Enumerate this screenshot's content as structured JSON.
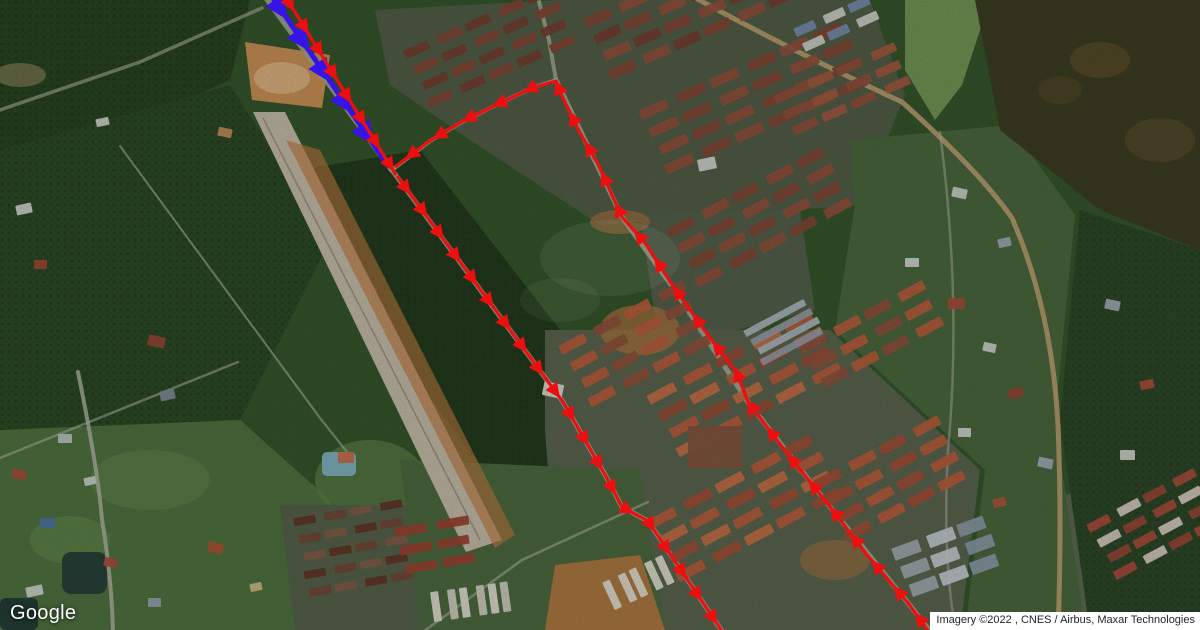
{
  "map": {
    "logo_text": "Google",
    "attribution": "Imagery ©2022 , CNES / Airbus, Maxar Technologies"
  },
  "routes": {
    "blue": {
      "color": "#3613e6",
      "line_width": 5,
      "arrow_length": 24,
      "arrow_half_width": 11,
      "spacing": 38,
      "phase": 24,
      "points": [
        [
          266,
          -12
        ],
        [
          389,
          167
        ]
      ]
    },
    "red": {
      "color": "#ed0f0f",
      "line_width": 3.2,
      "arrow_length": 15,
      "arrow_half_width": 7.2,
      "segments": [
        {
          "spacing": 27,
          "phase": 18,
          "points": [
            [
              280,
              -12
            ],
            [
              396,
              175
            ]
          ]
        },
        {
          "spacing": 28,
          "phase": 14,
          "points": [
            [
              397,
              176
            ],
            [
              563,
              402
            ],
            [
              608,
              480
            ],
            [
              622,
              507
            ],
            [
              648,
              521
            ],
            [
              724,
              634
            ]
          ]
        },
        {
          "spacing": 34,
          "phase": 20,
          "points": [
            [
              932,
              636
            ],
            [
              908,
              603
            ],
            [
              868,
              556
            ],
            [
              827,
              503
            ],
            [
              786,
              452
            ],
            [
              748,
              402
            ],
            [
              737,
              373
            ],
            [
              710,
              338
            ],
            [
              673,
              286
            ],
            [
              645,
              243
            ],
            [
              622,
              217
            ],
            [
              598,
              164
            ],
            [
              580,
              133
            ],
            [
              562,
              96
            ],
            [
              556,
              81
            ],
            [
              532,
              88
            ],
            [
              500,
              103
            ],
            [
              463,
              121
            ],
            [
              428,
              142
            ],
            [
              395,
              167
            ]
          ]
        }
      ]
    }
  },
  "map_features": {
    "building_clusters": [
      {
        "x": 585,
        "y": 18,
        "angle": -24,
        "rows": 4,
        "cols": 8,
        "w": 28,
        "h": 10,
        "gx": 7,
        "gy": 9,
        "colors": [
          "#7b4433",
          "#8a4e3a",
          "#6f3d2e"
        ]
      },
      {
        "x": 640,
        "y": 110,
        "angle": -24,
        "rows": 4,
        "cols": 6,
        "w": 30,
        "h": 10,
        "gx": 8,
        "gy": 10,
        "colors": [
          "#8a4e3a",
          "#7b4433"
        ]
      },
      {
        "x": 405,
        "y": 50,
        "angle": -24,
        "rows": 4,
        "cols": 5,
        "w": 26,
        "h": 9,
        "gx": 7,
        "gy": 9,
        "colors": [
          "#6f3d2e",
          "#7b4433"
        ]
      },
      {
        "x": 775,
        "y": 95,
        "angle": -24,
        "rows": 3,
        "cols": 4,
        "w": 26,
        "h": 9,
        "gx": 8,
        "gy": 9,
        "colors": [
          "#8a4e3a",
          "#9a563e"
        ]
      },
      {
        "x": 795,
        "y": 28,
        "angle": -24,
        "rows": 2,
        "cols": 3,
        "w": 22,
        "h": 9,
        "gx": 7,
        "gy": 8,
        "colors": [
          "#7288a8",
          "#c4c9c2"
        ]
      },
      {
        "x": 668,
        "y": 228,
        "angle": -28,
        "rows": 4,
        "cols": 5,
        "w": 28,
        "h": 10,
        "gx": 8,
        "gy": 9,
        "colors": [
          "#7b4433",
          "#8a4e3a"
        ]
      },
      {
        "x": 560,
        "y": 345,
        "angle": -28,
        "rows": 4,
        "cols": 4,
        "w": 28,
        "h": 10,
        "gx": 8,
        "gy": 10,
        "colors": [
          "#b05a3a",
          "#8a4e3a"
        ]
      },
      {
        "x": 648,
        "y": 395,
        "angle": -28,
        "rows": 4,
        "cols": 5,
        "w": 30,
        "h": 10,
        "gx": 8,
        "gy": 10,
        "colors": [
          "#bc6a42",
          "#b05a3a",
          "#8f4a34"
        ]
      },
      {
        "x": 800,
        "y": 345,
        "angle": -28,
        "rows": 3,
        "cols": 4,
        "w": 28,
        "h": 10,
        "gx": 8,
        "gy": 10,
        "colors": [
          "#8a4e3a",
          "#b05a3a"
        ]
      },
      {
        "x": 745,
        "y": 330,
        "angle": -28,
        "rows": 4,
        "cols": 1,
        "w": 68,
        "h": 7,
        "gx": 0,
        "gy": 4,
        "colors": [
          "#a7aeb4",
          "#8e969e"
        ]
      },
      {
        "x": 648,
        "y": 520,
        "angle": -28,
        "rows": 4,
        "cols": 5,
        "w": 30,
        "h": 10,
        "gx": 8,
        "gy": 10,
        "colors": [
          "#b05a3a",
          "#9a4c36",
          "#bc6a42"
        ]
      },
      {
        "x": 815,
        "y": 480,
        "angle": -28,
        "rows": 4,
        "cols": 4,
        "w": 28,
        "h": 10,
        "gx": 8,
        "gy": 10,
        "colors": [
          "#9a4c36",
          "#b05a3a"
        ]
      },
      {
        "x": 1088,
        "y": 524,
        "angle": -28,
        "rows": 4,
        "cols": 4,
        "w": 24,
        "h": 9,
        "gx": 7,
        "gy": 9,
        "colors": [
          "#a04a3a",
          "#cdc4b8",
          "#8f4434"
        ]
      },
      {
        "x": 893,
        "y": 548,
        "angle": -20,
        "rows": 3,
        "cols": 3,
        "w": 28,
        "h": 13,
        "gx": 6,
        "gy": 7,
        "colors": [
          "#9aa3a8",
          "#bcc4c8",
          "#8794a0"
        ]
      },
      {
        "x": 295,
        "y": 518,
        "angle": -10,
        "rows": 5,
        "cols": 4,
        "w": 22,
        "h": 8,
        "gx": 6,
        "gy": 10,
        "colors": [
          "#5e3427",
          "#6d4433",
          "#7a5a44"
        ]
      },
      {
        "x": 396,
        "y": 528,
        "angle": -10,
        "rows": 3,
        "cols": 2,
        "w": 32,
        "h": 9,
        "gx": 8,
        "gy": 10,
        "colors": [
          "#93402e"
        ]
      },
      {
        "x": 432,
        "y": 592,
        "angle": -8,
        "rows": 1,
        "cols": 6,
        "w": 8,
        "h": 30,
        "gx": 6,
        "gy": 0,
        "colors": [
          "#d8d5c8",
          "#c9c6ba"
        ]
      },
      {
        "x": 604,
        "y": 582,
        "angle": -25,
        "rows": 1,
        "cols": 5,
        "w": 8,
        "h": 30,
        "gx": 6,
        "gy": 0,
        "colors": [
          "#d8d5c8"
        ]
      }
    ],
    "houses": [
      [
        16,
        204,
        16,
        10,
        "#c6cbc4"
      ],
      [
        34,
        260,
        13,
        9,
        "#9c4434"
      ],
      [
        148,
        336,
        17,
        11,
        "#8f4434"
      ],
      [
        160,
        390,
        15,
        10,
        "#7a8890"
      ],
      [
        58,
        434,
        14,
        9,
        "#b6bdb9"
      ],
      [
        12,
        470,
        14,
        9,
        "#a34a38"
      ],
      [
        84,
        477,
        12,
        8,
        "#c2c8c4"
      ],
      [
        40,
        518,
        15,
        10,
        "#4d6f9e"
      ],
      [
        104,
        558,
        13,
        9,
        "#a34a38"
      ],
      [
        26,
        586,
        17,
        10,
        "#c6cbc4"
      ],
      [
        148,
        598,
        13,
        9,
        "#8f9ba5"
      ],
      [
        208,
        543,
        15,
        10,
        "#a8502e"
      ],
      [
        250,
        583,
        12,
        8,
        "#c4b47c"
      ],
      [
        338,
        452,
        16,
        11,
        "#c06848"
      ],
      [
        952,
        188,
        15,
        10,
        "#c4c9c2"
      ],
      [
        998,
        238,
        13,
        9,
        "#98a2ac"
      ],
      [
        948,
        298,
        17,
        11,
        "#a04a38"
      ],
      [
        983,
        343,
        13,
        9,
        "#c4c9c2"
      ],
      [
        1008,
        388,
        15,
        10,
        "#8f4434"
      ],
      [
        958,
        428,
        13,
        9,
        "#c6cbc4"
      ],
      [
        1038,
        458,
        15,
        10,
        "#9aa4ae"
      ],
      [
        993,
        498,
        13,
        9,
        "#a85238"
      ],
      [
        688,
        426,
        54,
        42,
        "#7c523a"
      ],
      [
        543,
        383,
        20,
        14,
        "#cfd3cc"
      ],
      [
        698,
        158,
        18,
        12,
        "#c9cec7"
      ],
      [
        905,
        258,
        14,
        9,
        "#c9cec7"
      ],
      [
        1105,
        300,
        15,
        10,
        "#9aa4ae"
      ],
      [
        1140,
        380,
        14,
        9,
        "#a34a38"
      ],
      [
        1120,
        450,
        15,
        10,
        "#c6cbc4"
      ],
      [
        218,
        128,
        14,
        9,
        "#b8865a"
      ],
      [
        96,
        118,
        13,
        8,
        "#c6cbc4"
      ]
    ]
  }
}
